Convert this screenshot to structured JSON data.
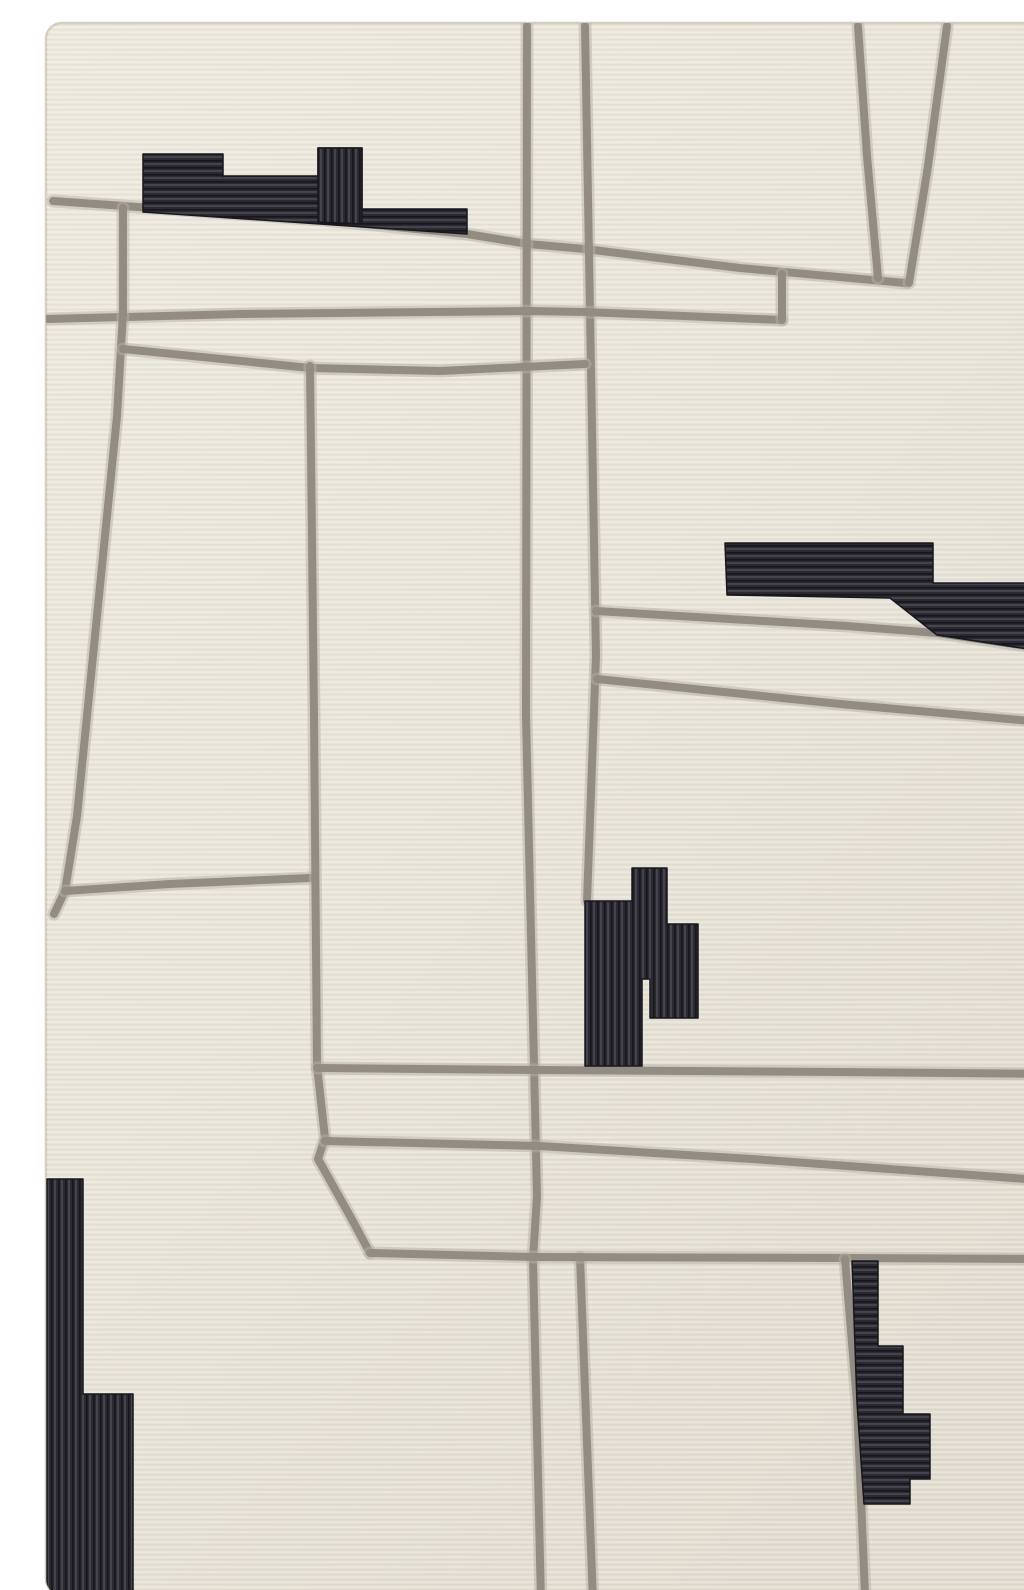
{
  "image": {
    "kind": "product-photo",
    "subject": "abstract modern area rug, top-down view",
    "width": 1024,
    "height": 1590
  },
  "palette": {
    "page_bg": "#ffffff",
    "rug_base_light": "#ece8dd",
    "rug_base": "#e8e4d8",
    "rug_base_dark": "#e1dccf",
    "rug_edge": "#d3cec0",
    "weave_highlight": "rgba(255,255,255,0.28)",
    "weave_shadow": "rgba(120,110,88,0.06)",
    "line_gray": "#938c82",
    "line_gray_halo": "#b6b0a5",
    "shape_black": "#2b2a31",
    "stripe_light": "#45444e",
    "stripe_dark": "#17161c"
  },
  "rug": {
    "x": 6,
    "y": 7,
    "width": 1008,
    "height": 1572,
    "corner_radius": 16
  },
  "line_style": {
    "main_width": 8,
    "halo_width": 13,
    "halo_opacity": 0.5
  },
  "lines": [
    {
      "name": "top-diagonal-line",
      "points": [
        [
          13,
          185
        ],
        [
          283,
          204
        ],
        [
          427,
          218
        ],
        [
          488,
          228
        ],
        [
          545,
          233
        ],
        [
          700,
          252
        ],
        [
          865,
          267
        ]
      ]
    },
    {
      "name": "top-right-v-left-branch",
      "points": [
        [
          818,
          10
        ],
        [
          827,
          140
        ],
        [
          838,
          262
        ]
      ]
    },
    {
      "name": "top-right-v-right-branch",
      "points": [
        [
          907,
          10
        ],
        [
          888,
          150
        ],
        [
          869,
          267
        ]
      ]
    },
    {
      "name": "center-vertical-line-left",
      "points": [
        [
          487,
          10
        ],
        [
          486,
          700
        ],
        [
          497,
          1180
        ],
        [
          493,
          1243
        ],
        [
          501,
          1586
        ]
      ]
    },
    {
      "name": "center-vertical-line-right",
      "points": [
        [
          545,
          10
        ],
        [
          556,
          640
        ],
        [
          547,
          885
        ]
      ]
    },
    {
      "name": "center-vertical-lower-stub",
      "points": [
        [
          540,
          1241
        ],
        [
          553,
          1586
        ]
      ]
    },
    {
      "name": "upper-horizontal-line",
      "points": [
        [
          8,
          303
        ],
        [
          200,
          298
        ],
        [
          488,
          295
        ],
        [
          545,
          296
        ],
        [
          742,
          304
        ]
      ]
    },
    {
      "name": "wedge-connector-line",
      "points": [
        [
          742,
          258
        ],
        [
          742,
          304
        ]
      ]
    },
    {
      "name": "left-upper-vertical-line",
      "points": [
        [
          83,
          192
        ],
        [
          83,
          297
        ],
        [
          77,
          400
        ],
        [
          37,
          800
        ],
        [
          25,
          875
        ],
        [
          14,
          898
        ]
      ]
    },
    {
      "name": "second-horizontal-line",
      "points": [
        [
          83,
          333
        ],
        [
          270,
          352
        ],
        [
          400,
          355
        ],
        [
          545,
          348
        ]
      ]
    },
    {
      "name": "left-mid-horizontal-line",
      "points": [
        [
          25,
          875
        ],
        [
          130,
          868
        ],
        [
          270,
          862
        ]
      ]
    },
    {
      "name": "mid-left-vertical-line",
      "points": [
        [
          270,
          350
        ],
        [
          274,
          700
        ],
        [
          277,
          1050
        ],
        [
          285,
          1122
        ],
        [
          278,
          1143
        ],
        [
          310,
          1200
        ],
        [
          330,
          1237
        ]
      ]
    },
    {
      "name": "right-diagonal-upper-line",
      "points": [
        [
          556,
          595
        ],
        [
          807,
          610
        ],
        [
          897,
          617
        ],
        [
          1014,
          634
        ]
      ]
    },
    {
      "name": "right-diagonal-lower-line",
      "points": [
        [
          557,
          663
        ],
        [
          800,
          688
        ],
        [
          1014,
          707
        ]
      ]
    },
    {
      "name": "mid-horizontal-line-1",
      "points": [
        [
          277,
          1052
        ],
        [
          500,
          1054
        ],
        [
          800,
          1056
        ],
        [
          1014,
          1058
        ]
      ]
    },
    {
      "name": "mid-horizontal-line-2",
      "points": [
        [
          285,
          1125
        ],
        [
          500,
          1130
        ],
        [
          712,
          1143
        ],
        [
          1014,
          1165
        ]
      ]
    },
    {
      "name": "bottom-horizontal-line",
      "points": [
        [
          330,
          1237
        ],
        [
          493,
          1241
        ],
        [
          805,
          1242
        ],
        [
          1014,
          1243
        ]
      ]
    },
    {
      "name": "bottom-right-vertical-line",
      "points": [
        [
          805,
          1243
        ],
        [
          817,
          1387
        ],
        [
          825,
          1578
        ]
      ]
    }
  ],
  "shapes": [
    {
      "name": "top-left-blocks",
      "stripes": "horizontal",
      "points": [
        [
          103,
          138
        ],
        [
          183,
          138
        ],
        [
          183,
          160
        ],
        [
          278,
          160
        ],
        [
          278,
          132
        ],
        [
          322,
          132
        ],
        [
          322,
          193
        ],
        [
          427,
          193
        ],
        [
          427,
          218
        ],
        [
          103,
          196
        ]
      ]
    },
    {
      "name": "top-left-vertical-block",
      "stripes": "vertical",
      "points": [
        [
          278,
          132
        ],
        [
          322,
          132
        ],
        [
          322,
          208
        ],
        [
          278,
          206
        ]
      ]
    },
    {
      "name": "right-blocks",
      "stripes": "horizontal",
      "points": [
        [
          685,
          527
        ],
        [
          893,
          527
        ],
        [
          893,
          567
        ],
        [
          993,
          567
        ],
        [
          993,
          458
        ],
        [
          1014,
          458
        ],
        [
          1014,
          637
        ],
        [
          897,
          619
        ],
        [
          850,
          582
        ],
        [
          687,
          579
        ]
      ]
    },
    {
      "name": "center-blocks",
      "stripes": "vertical",
      "points": [
        [
          545,
          885
        ],
        [
          592,
          885
        ],
        [
          592,
          852
        ],
        [
          627,
          852
        ],
        [
          627,
          908
        ],
        [
          658,
          908
        ],
        [
          658,
          1002
        ],
        [
          610,
          1002
        ],
        [
          610,
          963
        ],
        [
          602,
          963
        ],
        [
          602,
          1050
        ],
        [
          545,
          1050
        ]
      ]
    },
    {
      "name": "bottom-right-blocks",
      "stripes": "horizontal",
      "points": [
        [
          812,
          1245
        ],
        [
          838,
          1245
        ],
        [
          838,
          1330
        ],
        [
          863,
          1330
        ],
        [
          863,
          1398
        ],
        [
          890,
          1398
        ],
        [
          890,
          1463
        ],
        [
          870,
          1463
        ],
        [
          870,
          1488
        ],
        [
          824,
          1488
        ],
        [
          817,
          1387
        ]
      ]
    },
    {
      "name": "bottom-left-blocks",
      "stripes": "vertical",
      "points": [
        [
          7,
          1163
        ],
        [
          43,
          1163
        ],
        [
          43,
          1378
        ],
        [
          93,
          1378
        ],
        [
          93,
          1578
        ],
        [
          7,
          1578
        ]
      ]
    }
  ]
}
